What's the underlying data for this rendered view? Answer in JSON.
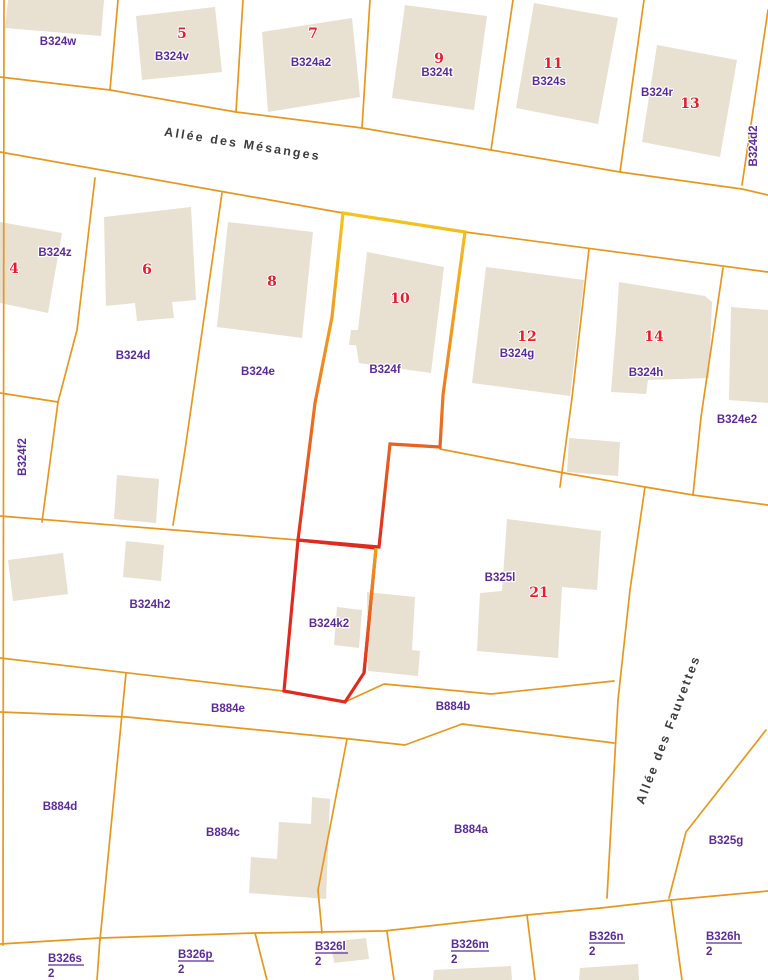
{
  "map": {
    "streets": [
      {
        "name": "Allée des Mésanges"
      },
      {
        "name": "Allée des Fauvettes"
      }
    ],
    "parcel_labels": [
      "B324w",
      "B324v",
      "B324a2",
      "B324t",
      "B324s",
      "B324r",
      "B324d2",
      "B324z",
      "B324d",
      "B324e",
      "B324f",
      "B324g",
      "B324h",
      "B324e2",
      "B324f2",
      "B324h2",
      "B324k2",
      "B325l",
      "B884e",
      "B884b",
      "B884d",
      "B884c",
      "B884a",
      "B325g"
    ],
    "house_numbers": [
      "5",
      "7",
      "9",
      "11",
      "13",
      "4",
      "6",
      "8",
      "10",
      "12",
      "14",
      "21"
    ],
    "fractions": [
      {
        "num": "B326s",
        "den": "2"
      },
      {
        "num": "B326p",
        "den": "2"
      },
      {
        "num": "B326l",
        "den": "2"
      },
      {
        "num": "B326m",
        "den": "2"
      },
      {
        "num": "B326n",
        "den": "2"
      },
      {
        "num": "B326h",
        "den": "2"
      }
    ],
    "highlighted_parcels": [
      "B324f",
      "B324k2"
    ],
    "colors": {
      "boundary": "#E8971E",
      "building": "#E8E0D1",
      "highlight_yellow": "#F4C51B",
      "highlight_orange": "#F29120",
      "highlight_red": "#DF2B1D",
      "parcel_label": "#5B2B9B",
      "house_number": "#E51E2C",
      "street_name": "#3D3D3D"
    }
  }
}
